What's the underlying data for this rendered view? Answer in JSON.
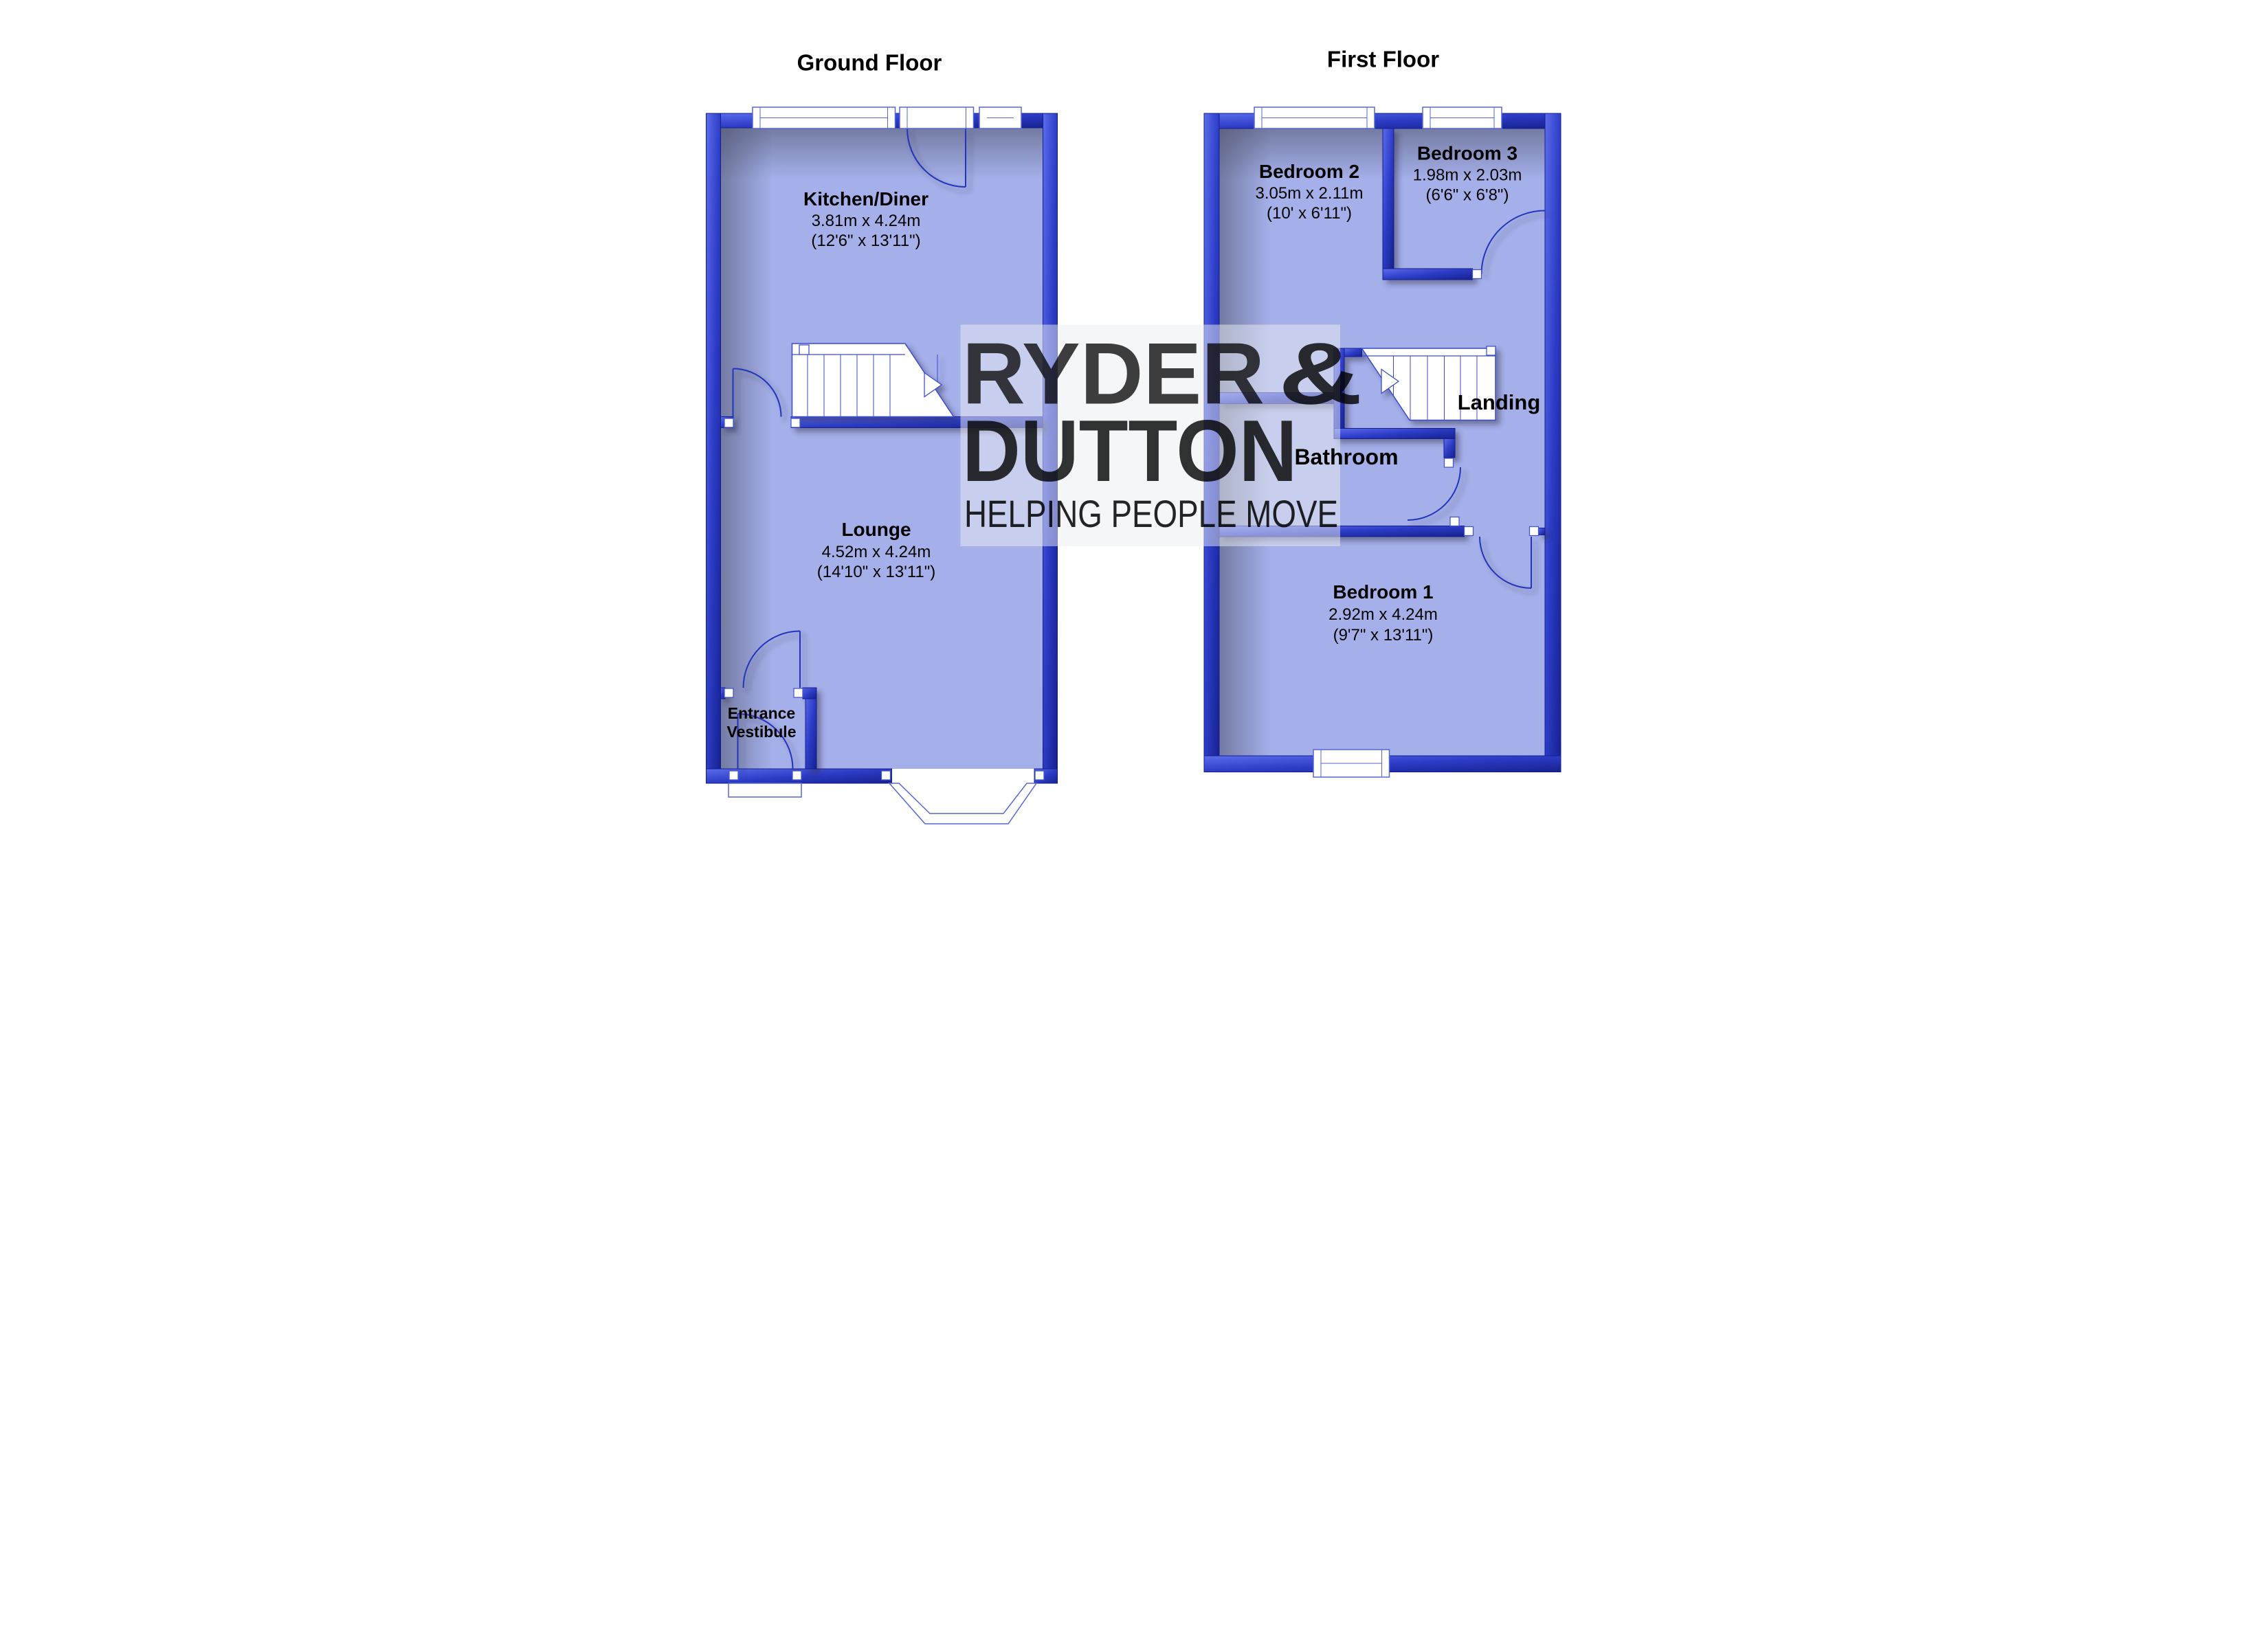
{
  "ground": {
    "title": "Ground Floor",
    "kitchen": {
      "name": "Kitchen/Diner",
      "metric": "3.81m x 4.24m",
      "imperial": "(12'6\" x 13'11\")"
    },
    "lounge": {
      "name": "Lounge",
      "metric": "4.52m x 4.24m",
      "imperial": "(14'10\" x 13'11\")"
    },
    "vestibule": {
      "line1": "Entrance",
      "line2": "Vestibule"
    }
  },
  "first": {
    "title": "First Floor",
    "bedroom2": {
      "name": "Bedroom 2",
      "metric": "3.05m x 2.11m",
      "imperial": "(10' x 6'11\")"
    },
    "bedroom3": {
      "name": "Bedroom 3",
      "metric": "1.98m x 2.03m",
      "imperial": "(6'6\" x 6'8\")"
    },
    "bedroom1": {
      "name": "Bedroom 1",
      "metric": "2.92m x 4.24m",
      "imperial": "(9'7\" x 13'11\")"
    },
    "bathroom": {
      "name": "Bathroom"
    },
    "landing": {
      "name": "Landing"
    }
  },
  "watermark": {
    "brand_top": "RYDER",
    "brand_amp": "&",
    "brand_bottom": "DUTTON",
    "tagline": "HELPING PEOPLE MOVE"
  },
  "colors": {
    "wall_blue": "#2c3cc6",
    "room_fill": "#a5b0ea",
    "watermark_pink": "#dfa6c6",
    "watermark_cream": "#f4ecd2"
  }
}
